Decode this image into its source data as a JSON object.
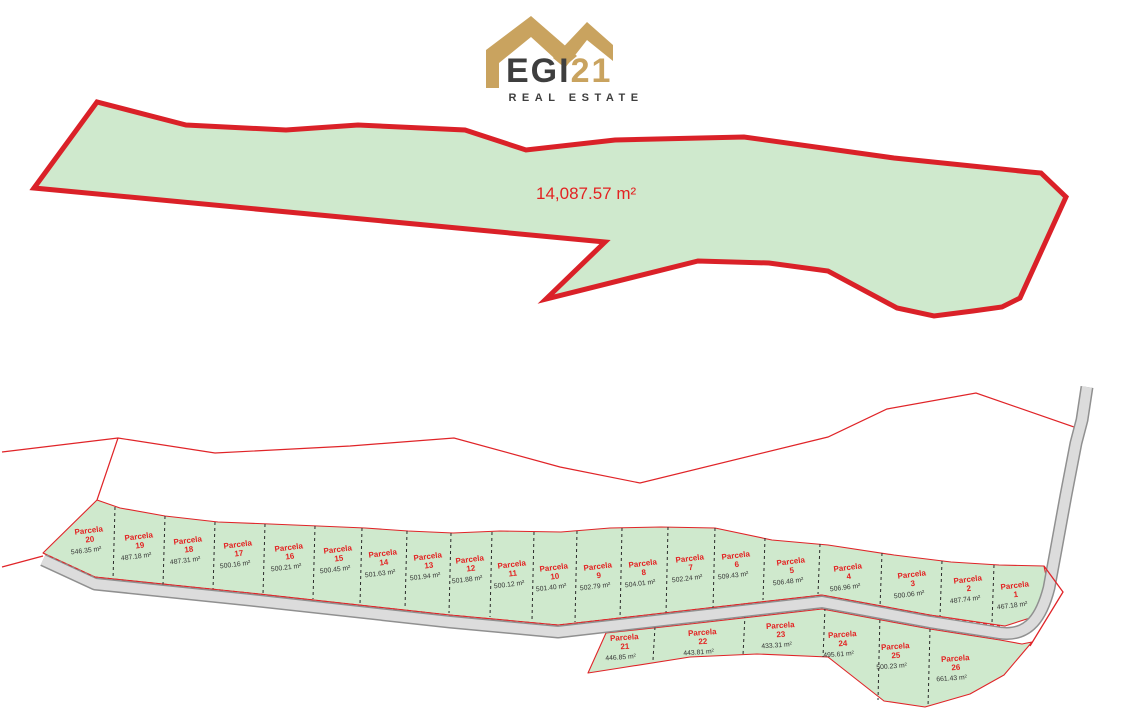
{
  "logo": {
    "brand_bold": "EGI",
    "brand_accent": "21",
    "tagline": "REAL ESTATE"
  },
  "main_plot": {
    "area_label": "14,087.57 m²"
  },
  "subdivision": {
    "label_prefix": "Parcela",
    "parcels": [
      {
        "number": "20",
        "area": "546.35 m²",
        "x": 90,
        "y": 534,
        "row": "top"
      },
      {
        "number": "19",
        "area": "487.18 m²",
        "x": 140,
        "y": 540,
        "row": "top"
      },
      {
        "number": "18",
        "area": "487.31 m²",
        "x": 189,
        "y": 544,
        "row": "top"
      },
      {
        "number": "17",
        "area": "500.16 m²",
        "x": 239,
        "y": 548,
        "row": "top"
      },
      {
        "number": "16",
        "area": "500.21 m²",
        "x": 290,
        "y": 551,
        "row": "top"
      },
      {
        "number": "15",
        "area": "500.45 m²",
        "x": 339,
        "y": 553,
        "row": "top"
      },
      {
        "number": "14",
        "area": "501.63 m²",
        "x": 384,
        "y": 557,
        "row": "top"
      },
      {
        "number": "13",
        "area": "501.94 m²",
        "x": 429,
        "y": 560,
        "row": "top"
      },
      {
        "number": "12",
        "area": "501.88 m²",
        "x": 471,
        "y": 563,
        "row": "top"
      },
      {
        "number": "11",
        "area": "500.12 m²",
        "x": 513,
        "y": 568,
        "row": "top"
      },
      {
        "number": "10",
        "area": "501.40 m²",
        "x": 555,
        "y": 571,
        "row": "top"
      },
      {
        "number": "9",
        "area": "502.79 m²",
        "x": 599,
        "y": 570,
        "row": "top"
      },
      {
        "number": "8",
        "area": "504.01 m²",
        "x": 644,
        "y": 567,
        "row": "top"
      },
      {
        "number": "7",
        "area": "502.24 m²",
        "x": 691,
        "y": 562,
        "row": "top"
      },
      {
        "number": "6",
        "area": "509.43 m²",
        "x": 737,
        "y": 559,
        "row": "top"
      },
      {
        "number": "5",
        "area": "506.48 m²",
        "x": 792,
        "y": 565,
        "row": "top"
      },
      {
        "number": "4",
        "area": "506.96 m²",
        "x": 849,
        "y": 571,
        "row": "top"
      },
      {
        "number": "3",
        "area": "500.06 m²",
        "x": 913,
        "y": 578,
        "row": "top"
      },
      {
        "number": "2",
        "area": "487.74 m²",
        "x": 969,
        "y": 583,
        "row": "top"
      },
      {
        "number": "1",
        "area": "467.18 m²",
        "x": 1016,
        "y": 589,
        "row": "top"
      },
      {
        "number": "21",
        "area": "446.85 m²",
        "x": 625,
        "y": 641,
        "row": "bottom"
      },
      {
        "number": "22",
        "area": "443.81 m²",
        "x": 703,
        "y": 636,
        "row": "bottom"
      },
      {
        "number": "23",
        "area": "433.31 m²",
        "x": 781,
        "y": 629,
        "row": "bottom"
      },
      {
        "number": "24",
        "area": "495.61 m²",
        "x": 843,
        "y": 638,
        "row": "bottom"
      },
      {
        "number": "25",
        "area": "500.23 m²",
        "x": 896,
        "y": 650,
        "row": "bottom"
      },
      {
        "number": "26",
        "area": "661.43 m²",
        "x": 956,
        "y": 662,
        "row": "bottom"
      }
    ]
  },
  "colors": {
    "parcel_fill": "#cfe9cd",
    "boundary_red": "#e02428",
    "label_red": "#e32222",
    "area_text": "#333333",
    "road_fill": "#dcdcdc",
    "road_casing": "#909090",
    "brand_gold": "#c9a35f",
    "brand_dark": "#3e3e3e"
  }
}
